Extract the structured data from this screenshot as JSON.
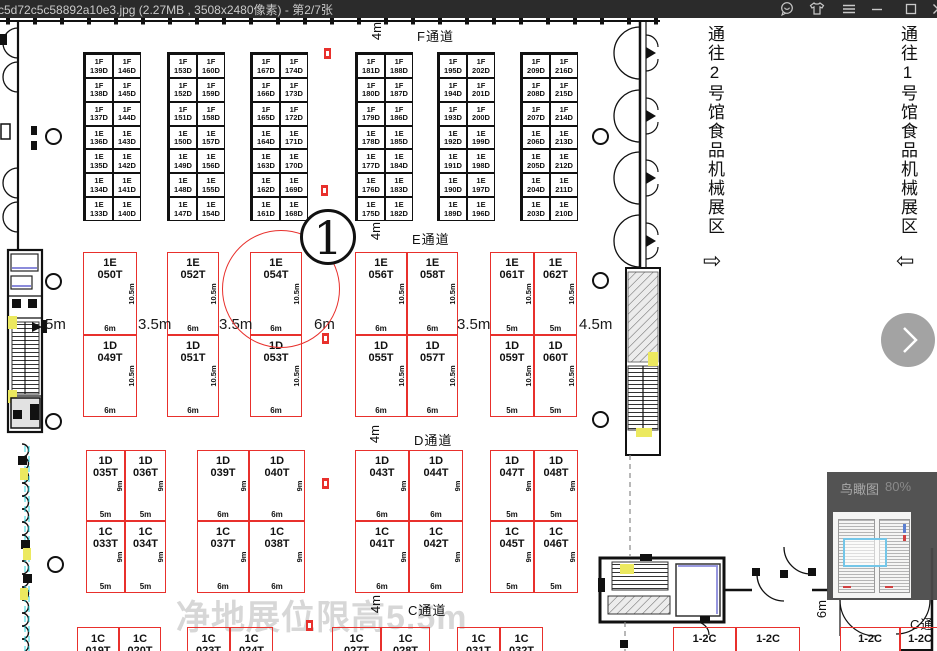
{
  "window": {
    "title": "c5d72c5c58892a10e3.jpg (2.27MB , 3508x2480像素) - 第2/7张",
    "control_names": [
      "feedback",
      "skin",
      "menu",
      "minimize",
      "maximize",
      "close"
    ]
  },
  "viewer": {
    "navigator": {
      "title": "鸟瞰图",
      "zoom_level": "80%"
    }
  },
  "plan": {
    "hall_badge": "1",
    "watermark": "净地展位限高5.5m",
    "top_aisle": {
      "dim": "4m",
      "label": "F通道"
    },
    "e_aisle": {
      "dim": "4m",
      "label": "E通道"
    },
    "d_aisle": {
      "dim": "4m",
      "label": "D通道"
    },
    "c_aisle": {
      "dim": "4m",
      "label": "C通道"
    },
    "corner_aisle": {
      "dim": "6m",
      "label": "C通"
    },
    "corridor_left": {
      "text": "通往2号馆食品机械展区",
      "arrow": "⇨"
    },
    "corridor_right": {
      "text": "通往1号馆食品机械展区",
      "arrow": "⇦"
    },
    "left_dim": "5m",
    "mid_gaps": [
      "3.5m",
      "3.5m",
      "6m",
      "3.5m",
      "4.5m"
    ],
    "mid_h_dim": "10.5m",
    "low_h_dim": "9m",
    "small_groups": [
      {
        "rows": [
          [
            "1F|139D",
            "1F|146D"
          ],
          [
            "1F|138D",
            "1F|145D"
          ],
          [
            "1F|137D",
            "1F|144D"
          ],
          [
            "1E|136D",
            "1E|143D"
          ],
          [
            "1E|135D",
            "1E|142D"
          ],
          [
            "1E|134D",
            "1E|141D"
          ],
          [
            "1E|133D",
            "1E|140D"
          ]
        ]
      },
      {
        "rows": [
          [
            "1F|153D",
            "1F|160D"
          ],
          [
            "1F|152D",
            "1F|159D"
          ],
          [
            "1F|151D",
            "1F|158D"
          ],
          [
            "1E|150D",
            "1E|157D"
          ],
          [
            "1E|149D",
            "1E|156D"
          ],
          [
            "1E|148D",
            "1E|155D"
          ],
          [
            "1E|147D",
            "1E|154D"
          ]
        ]
      },
      {
        "rows": [
          [
            "1F|167D",
            "1F|174D"
          ],
          [
            "1F|166D",
            "1F|173D"
          ],
          [
            "1F|165D",
            "1F|172D"
          ],
          [
            "1E|164D",
            "1E|171D"
          ],
          [
            "1E|163D",
            "1E|170D"
          ],
          [
            "1E|162D",
            "1E|169D"
          ],
          [
            "1E|161D",
            "1E|168D"
          ]
        ]
      },
      {
        "rows": [
          [
            "1F|181D",
            "1F|188D"
          ],
          [
            "1F|180D",
            "1F|187D"
          ],
          [
            "1F|179D",
            "1F|186D"
          ],
          [
            "1E|178D",
            "1E|185D"
          ],
          [
            "1E|177D",
            "1E|184D"
          ],
          [
            "1E|176D",
            "1E|183D"
          ],
          [
            "1E|175D",
            "1E|182D"
          ]
        ]
      },
      {
        "rows": [
          [
            "1F|195D",
            "1F|202D"
          ],
          [
            "1F|194D",
            "1F|201D"
          ],
          [
            "1F|193D",
            "1F|200D"
          ],
          [
            "1E|192D",
            "1E|199D"
          ],
          [
            "1E|191D",
            "1E|198D"
          ],
          [
            "1E|190D",
            "1E|197D"
          ],
          [
            "1E|189D",
            "1E|196D"
          ]
        ]
      },
      {
        "rows": [
          [
            "1F|209D",
            "1F|216D"
          ],
          [
            "1F|208D",
            "1F|215D"
          ],
          [
            "1F|207D",
            "1F|214D"
          ],
          [
            "1E|206D",
            "1E|213D"
          ],
          [
            "1E|205D",
            "1E|212D"
          ],
          [
            "1E|204D",
            "1E|211D"
          ],
          [
            "1E|203D",
            "1E|210D"
          ]
        ]
      }
    ],
    "mid_blocks": [
      {
        "cols": [
          {
            "top": "1E|050T",
            "bot": "1D|049T",
            "w": "6m"
          }
        ]
      },
      {
        "cols": [
          {
            "top": "1E|052T",
            "bot": "1D|051T",
            "w": "6m"
          }
        ]
      },
      {
        "cols": [
          {
            "top": "1E|054T",
            "bot": "1D|053T",
            "w": "6m"
          }
        ]
      },
      {
        "cols": [
          {
            "top": "1E|056T",
            "bot": "1D|055T",
            "w": "6m"
          },
          {
            "top": "1E|058T",
            "bot": "1D|057T",
            "w": "6m"
          }
        ]
      },
      {
        "cols": [
          {
            "top": "1E|061T",
            "bot": "1D|059T",
            "w": "5m"
          },
          {
            "top": "1E|062T",
            "bot": "1D|060T",
            "w": "5m"
          }
        ]
      }
    ],
    "low_blocks": [
      {
        "cols": [
          {
            "top": "1D|035T",
            "bot": "1C|033T",
            "w": "5m"
          },
          {
            "top": "1D|036T",
            "bot": "1C|034T",
            "w": "5m"
          }
        ]
      },
      {
        "cols": [
          {
            "top": "1D|039T",
            "bot": "1C|037T",
            "w": "6m"
          },
          {
            "top": "1D|040T",
            "bot": "1C|038T",
            "w": "6m"
          }
        ]
      },
      {
        "cols": [
          {
            "top": "1D|043T",
            "bot": "1C|041T",
            "w": "6m"
          },
          {
            "top": "1D|044T",
            "bot": "1C|042T",
            "w": "6m"
          }
        ]
      },
      {
        "cols": [
          {
            "top": "1D|047T",
            "bot": "1C|045T",
            "w": "5m"
          },
          {
            "top": "1D|048T",
            "bot": "1C|046T",
            "w": "5m"
          }
        ]
      }
    ],
    "bottom_pairs": [
      [
        "1C|019T",
        "1C|020T"
      ],
      [
        "1C|023T",
        "1C|024T"
      ],
      [
        "1C|027T",
        "1C|028T"
      ],
      [
        "1C|031T",
        "1C|032T"
      ],
      [
        "1-2C",
        "1-2C"
      ],
      [
        "1-2C",
        "1-2C"
      ]
    ]
  },
  "colors": {
    "booth_red": "#e8302c",
    "titlebar": "#2b2b2b",
    "viewport_blue": "#74c6e8",
    "watermark_gray": "#bdbdbd"
  }
}
